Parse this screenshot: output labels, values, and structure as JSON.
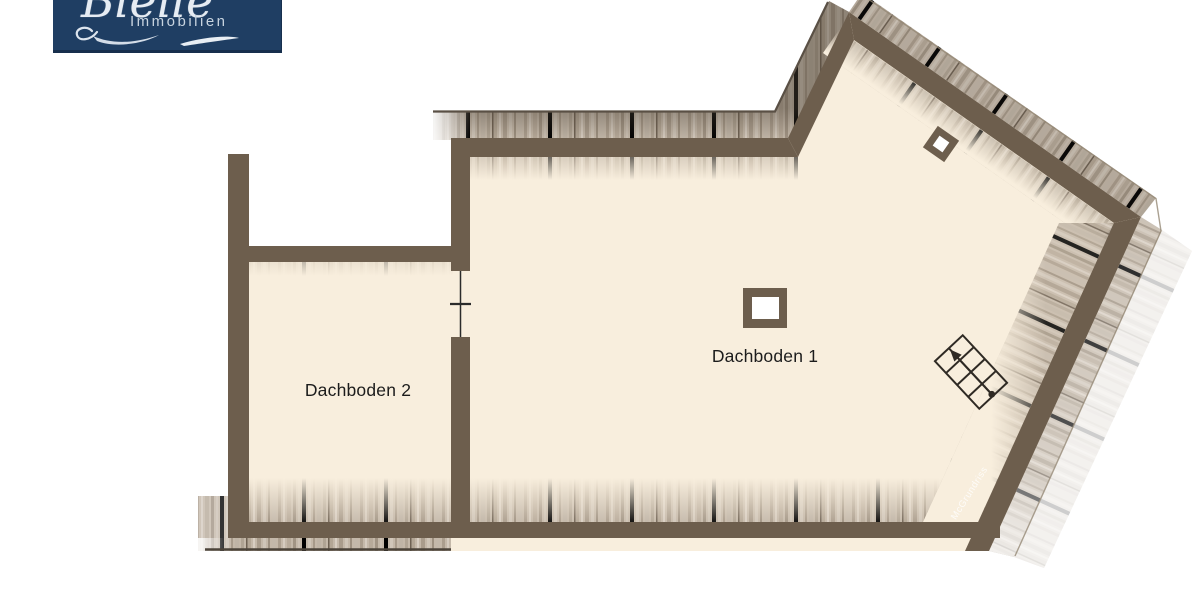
{
  "logo": {
    "script_text": "Bleile",
    "subtitle": "Immobilien",
    "bg_color": "#1f3e63",
    "text_color": "#c7d3df"
  },
  "floorplan": {
    "rooms": [
      {
        "name": "Dachboden 1"
      },
      {
        "name": "Dachboden 2"
      }
    ],
    "watermark": "McGrundriss",
    "icons": [
      "stairs-icon",
      "door-opening-icon",
      "chimney-icon",
      "skylight-icon"
    ],
    "colors": {
      "wall": "#6d5e4d",
      "floor": "#f8eedd",
      "hatch_base": "#c4b8a9",
      "hatch_dark": "#9a8d7d",
      "edge_line": "#55493d",
      "stair_stroke": "#2f2a24"
    }
  }
}
